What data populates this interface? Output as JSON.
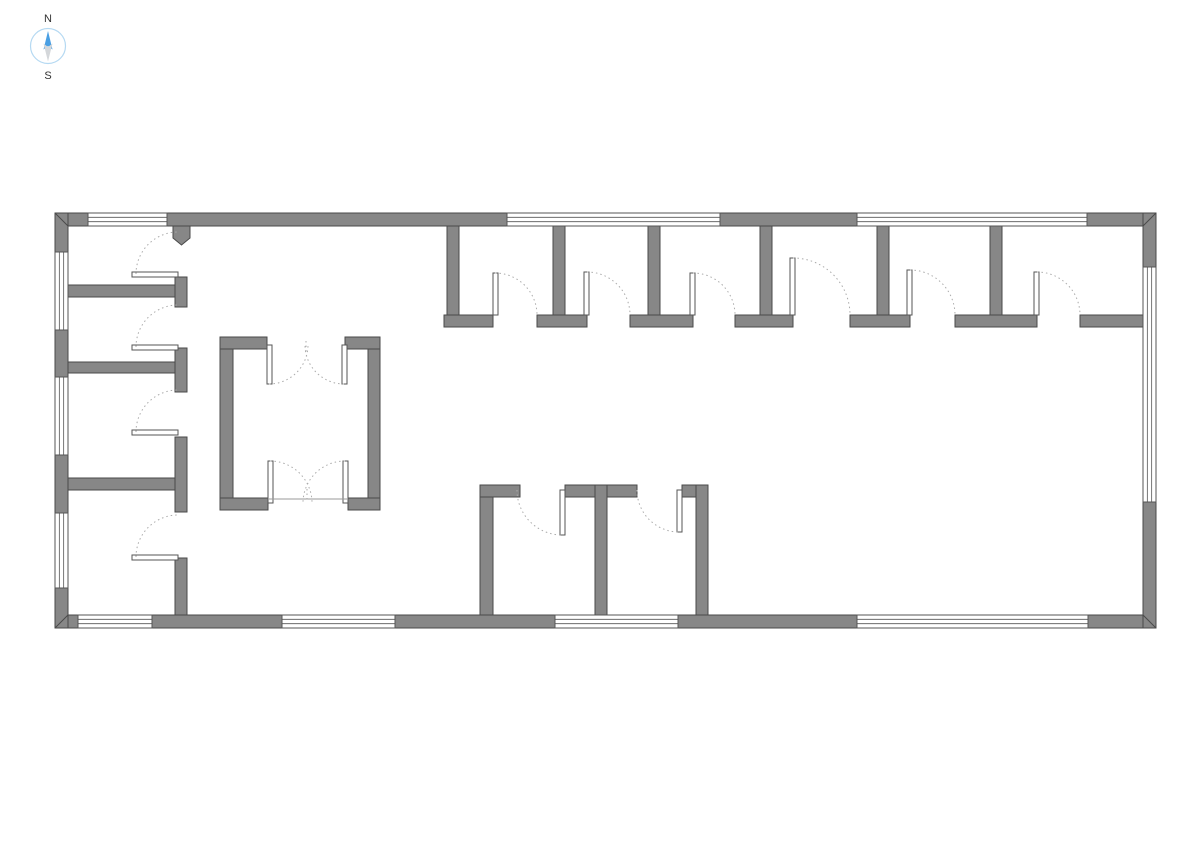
{
  "compass": {
    "north_label": "N",
    "south_label": "S",
    "north_color": "#4a9fe3",
    "south_color": "#d4d7da",
    "ring_color": "#b5d9f2"
  },
  "floorplan": {
    "background": "#ffffff",
    "wall_fill": "#878787",
    "wall_stroke": "#4a4a4a",
    "window_stroke": "#555555",
    "leaf_stroke": "#555555",
    "arc_color": "#ababab",
    "tick_color": "#9a9a9a",
    "walls": [
      [
        55,
        213,
        33,
        13
      ],
      [
        167,
        213,
        340,
        13
      ],
      [
        720,
        213,
        137,
        13
      ],
      [
        1087,
        213,
        69,
        13
      ],
      [
        55,
        615,
        23,
        13
      ],
      [
        152,
        615,
        130,
        13
      ],
      [
        395,
        615,
        160,
        13
      ],
      [
        678,
        615,
        179,
        13
      ],
      [
        1088,
        615,
        68,
        13
      ],
      [
        55,
        213,
        13,
        39
      ],
      [
        55,
        330,
        13,
        47
      ],
      [
        55,
        455,
        13,
        58
      ],
      [
        55,
        588,
        13,
        40
      ],
      [
        1143,
        213,
        13,
        54
      ],
      [
        1143,
        502,
        13,
        126
      ],
      [
        68,
        285,
        107,
        12
      ],
      [
        175,
        277,
        12,
        30
      ],
      [
        68,
        362,
        107,
        11
      ],
      [
        175,
        348,
        12,
        44
      ],
      [
        68,
        478,
        107,
        12
      ],
      [
        175,
        437,
        12,
        75
      ],
      [
        175,
        558,
        12,
        57
      ],
      [
        447,
        226,
        12,
        91
      ],
      [
        553,
        226,
        12,
        91
      ],
      [
        648,
        226,
        12,
        91
      ],
      [
        760,
        226,
        12,
        91
      ],
      [
        877,
        226,
        12,
        91
      ],
      [
        990,
        226,
        12,
        91
      ],
      [
        444,
        315,
        49,
        12
      ],
      [
        537,
        315,
        50,
        12
      ],
      [
        630,
        315,
        63,
        12
      ],
      [
        735,
        315,
        58,
        12
      ],
      [
        850,
        315,
        60,
        12
      ],
      [
        955,
        315,
        82,
        12
      ],
      [
        1080,
        315,
        63,
        12
      ],
      [
        480,
        485,
        13,
        130
      ],
      [
        480,
        485,
        40,
        12
      ],
      [
        565,
        485,
        72,
        12
      ],
      [
        595,
        485,
        12,
        130
      ],
      [
        682,
        485,
        26,
        12
      ],
      [
        696,
        485,
        12,
        130
      ],
      [
        220,
        337,
        13,
        173
      ],
      [
        368,
        337,
        12,
        173
      ],
      [
        220,
        337,
        47,
        12
      ],
      [
        345,
        337,
        35,
        12
      ],
      [
        220,
        498,
        48,
        12
      ],
      [
        348,
        498,
        32,
        12
      ]
    ],
    "stub_pentagon": "173,226 190,226 190,238 181.5,245 173,238",
    "mitres": [
      [
        55,
        213,
        68,
        226
      ],
      [
        1156,
        213,
        1143,
        226
      ],
      [
        55,
        628,
        68,
        615
      ],
      [
        1143,
        615,
        1156,
        628
      ]
    ],
    "windows": [
      [
        88,
        213,
        79,
        13
      ],
      [
        507,
        213,
        213,
        13
      ],
      [
        857,
        213,
        230,
        13
      ],
      [
        78,
        615,
        74,
        13
      ],
      [
        282,
        615,
        113,
        13
      ],
      [
        555,
        615,
        123,
        13
      ],
      [
        857,
        615,
        231,
        13
      ],
      [
        55,
        252,
        13,
        78
      ],
      [
        55,
        377,
        13,
        78
      ],
      [
        55,
        513,
        13,
        75
      ],
      [
        1143,
        267,
        13,
        235
      ]
    ],
    "door_leaves": [
      [
        132,
        272,
        46,
        5
      ],
      [
        132,
        345,
        46,
        5
      ],
      [
        132,
        430,
        46,
        5
      ],
      [
        132,
        555,
        46,
        5
      ],
      [
        493,
        273,
        5,
        42
      ],
      [
        584,
        272,
        5,
        43
      ],
      [
        690,
        273,
        5,
        42
      ],
      [
        790,
        258,
        5,
        57
      ],
      [
        907,
        270,
        5,
        45
      ],
      [
        1034,
        272,
        5,
        43
      ],
      [
        560,
        490,
        5,
        45
      ],
      [
        677,
        490,
        5,
        42
      ],
      [
        267,
        345,
        5,
        39
      ],
      [
        342,
        345,
        5,
        39
      ],
      [
        268,
        461,
        5,
        42
      ],
      [
        343,
        461,
        5,
        42
      ]
    ],
    "door_arcs": [
      {
        "cx": 178,
        "cy": 274,
        "r": 42,
        "a0": 180,
        "a1": 270,
        "sw": 1
      },
      {
        "cx": 178,
        "cy": 347,
        "r": 42,
        "a0": 180,
        "a1": 270,
        "sw": 1
      },
      {
        "cx": 178,
        "cy": 432,
        "r": 42,
        "a0": 180,
        "a1": 270,
        "sw": 1
      },
      {
        "cx": 178,
        "cy": 557,
        "r": 42,
        "a0": 180,
        "a1": 270,
        "sw": 1
      },
      {
        "cx": 495,
        "cy": 315,
        "r": 42,
        "a0": 270,
        "a1": 360,
        "sw": 1
      },
      {
        "cx": 587,
        "cy": 315,
        "r": 43,
        "a0": 270,
        "a1": 360,
        "sw": 1
      },
      {
        "cx": 693,
        "cy": 315,
        "r": 42,
        "a0": 270,
        "a1": 360,
        "sw": 1
      },
      {
        "cx": 793,
        "cy": 315,
        "r": 57,
        "a0": 270,
        "a1": 360,
        "sw": 1
      },
      {
        "cx": 910,
        "cy": 315,
        "r": 45,
        "a0": 270,
        "a1": 360,
        "sw": 1
      },
      {
        "cx": 1037,
        "cy": 315,
        "r": 43,
        "a0": 270,
        "a1": 360,
        "sw": 1
      },
      {
        "cx": 562,
        "cy": 490,
        "r": 45,
        "a0": 180,
        "a1": 90,
        "sw": 0
      },
      {
        "cx": 679,
        "cy": 490,
        "r": 42,
        "a0": 180,
        "a1": 90,
        "sw": 0
      },
      {
        "cx": 269,
        "cy": 345,
        "r": 39,
        "a0": 90,
        "a1": 0,
        "sw": 0
      },
      {
        "cx": 344,
        "cy": 345,
        "r": 39,
        "a0": 90,
        "a1": 180,
        "sw": 1
      },
      {
        "cx": 270,
        "cy": 503,
        "r": 42,
        "a0": 270,
        "a1": 360,
        "sw": 1
      },
      {
        "cx": 345,
        "cy": 503,
        "r": 42,
        "a0": 270,
        "a1": 180,
        "sw": 0
      }
    ],
    "threshold_lines": [
      [
        268,
        499,
        348,
        499
      ]
    ],
    "center_dashes": [
      [
        306,
        341,
        306,
        354
      ],
      [
        307,
        489,
        307,
        502
      ]
    ]
  }
}
